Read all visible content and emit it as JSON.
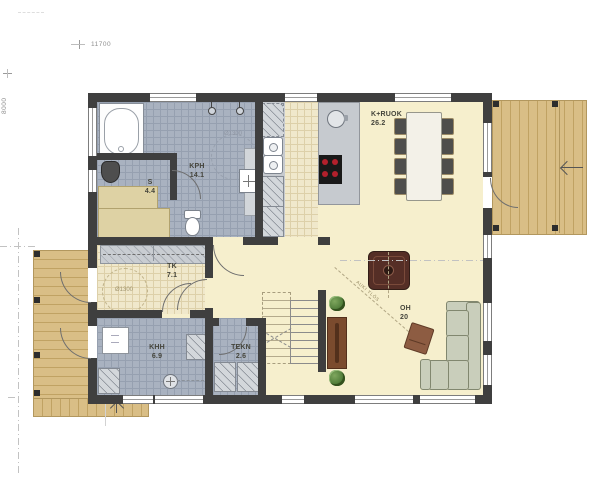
{
  "dimensions": {
    "top": "11700",
    "left": "8000"
  },
  "rooms": {
    "kph": {
      "label": "KPH",
      "area": "14.1"
    },
    "s": {
      "label": "S",
      "area": "4.4"
    },
    "tk": {
      "label": "TK",
      "area": "7.1"
    },
    "khh": {
      "label": "KHH",
      "area": "6.9"
    },
    "tekn": {
      "label": "TEKN",
      "area": "2.6"
    },
    "kruok": {
      "label": "K+RUOK",
      "area": "26.2"
    },
    "oh": {
      "label": "OH",
      "area": "20"
    }
  },
  "annotations": {
    "kph_circle": "Ø1300",
    "tk_circle": "Ø1300",
    "open_above": "AUKI YLÖS"
  },
  "colors": {
    "wall": "#3f3f3f",
    "wet_room_tile": "#a9b2c0",
    "entry_tile": "#f0e8cb",
    "main_floor": "#f6efcd",
    "deck_wood": "#d9be86",
    "counter": "#c6cacf",
    "burner_red": "#b3202c",
    "sofa_green": "#c9cebb",
    "fireplace_brown": "#552e26"
  }
}
